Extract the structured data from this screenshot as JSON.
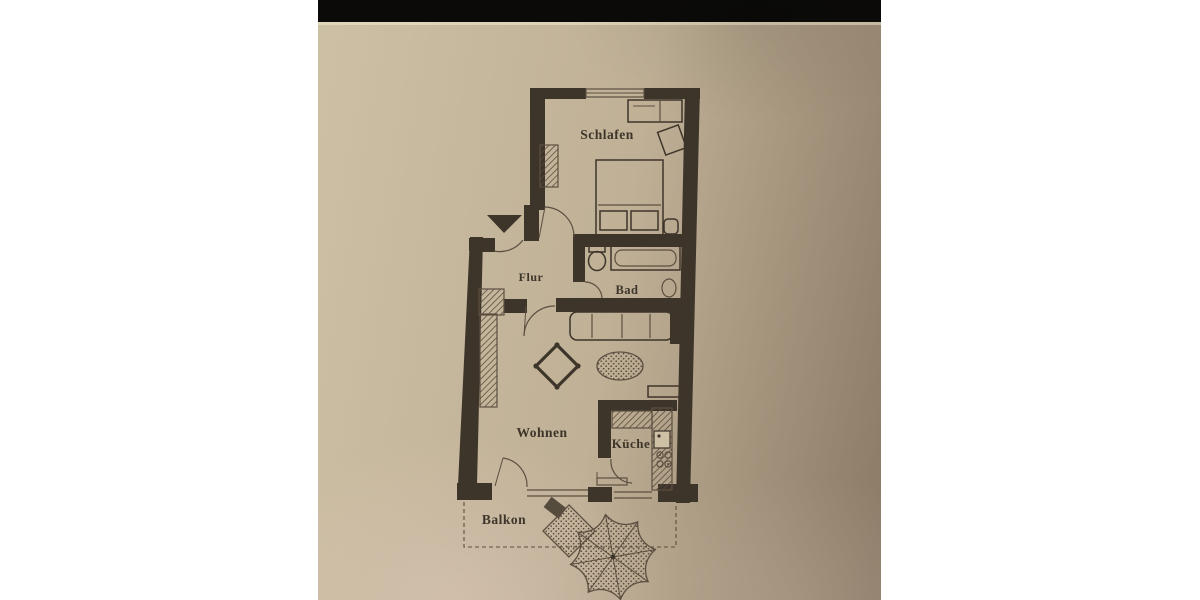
{
  "scene": {
    "description": "Photograph of a printed apartment floor plan on beige paper, centered on a white background with a black strip along the top of the photo"
  },
  "colors": {
    "page_bg": "#ffffff",
    "black_bar": "#0b0a09",
    "paper_light": "#cdc0a4",
    "paper_mid": "#bfb096",
    "paper_shadow": "#a3927b",
    "paper_dark": "#8c7c68",
    "ink": "#3e352a",
    "ink_soft": "#5c4f40"
  },
  "rooms": [
    {
      "id": "schlafen",
      "label": "Schlafen"
    },
    {
      "id": "flur",
      "label": "Flur"
    },
    {
      "id": "bad",
      "label": "Bad"
    },
    {
      "id": "wohnen",
      "label": "Wohnen"
    },
    {
      "id": "kueche",
      "label": "Küche"
    },
    {
      "id": "balkon",
      "label": "Balkon"
    }
  ],
  "icons": {
    "entrance_marker_icon": "filled black triangle pointing down at the apartment entrance door"
  }
}
